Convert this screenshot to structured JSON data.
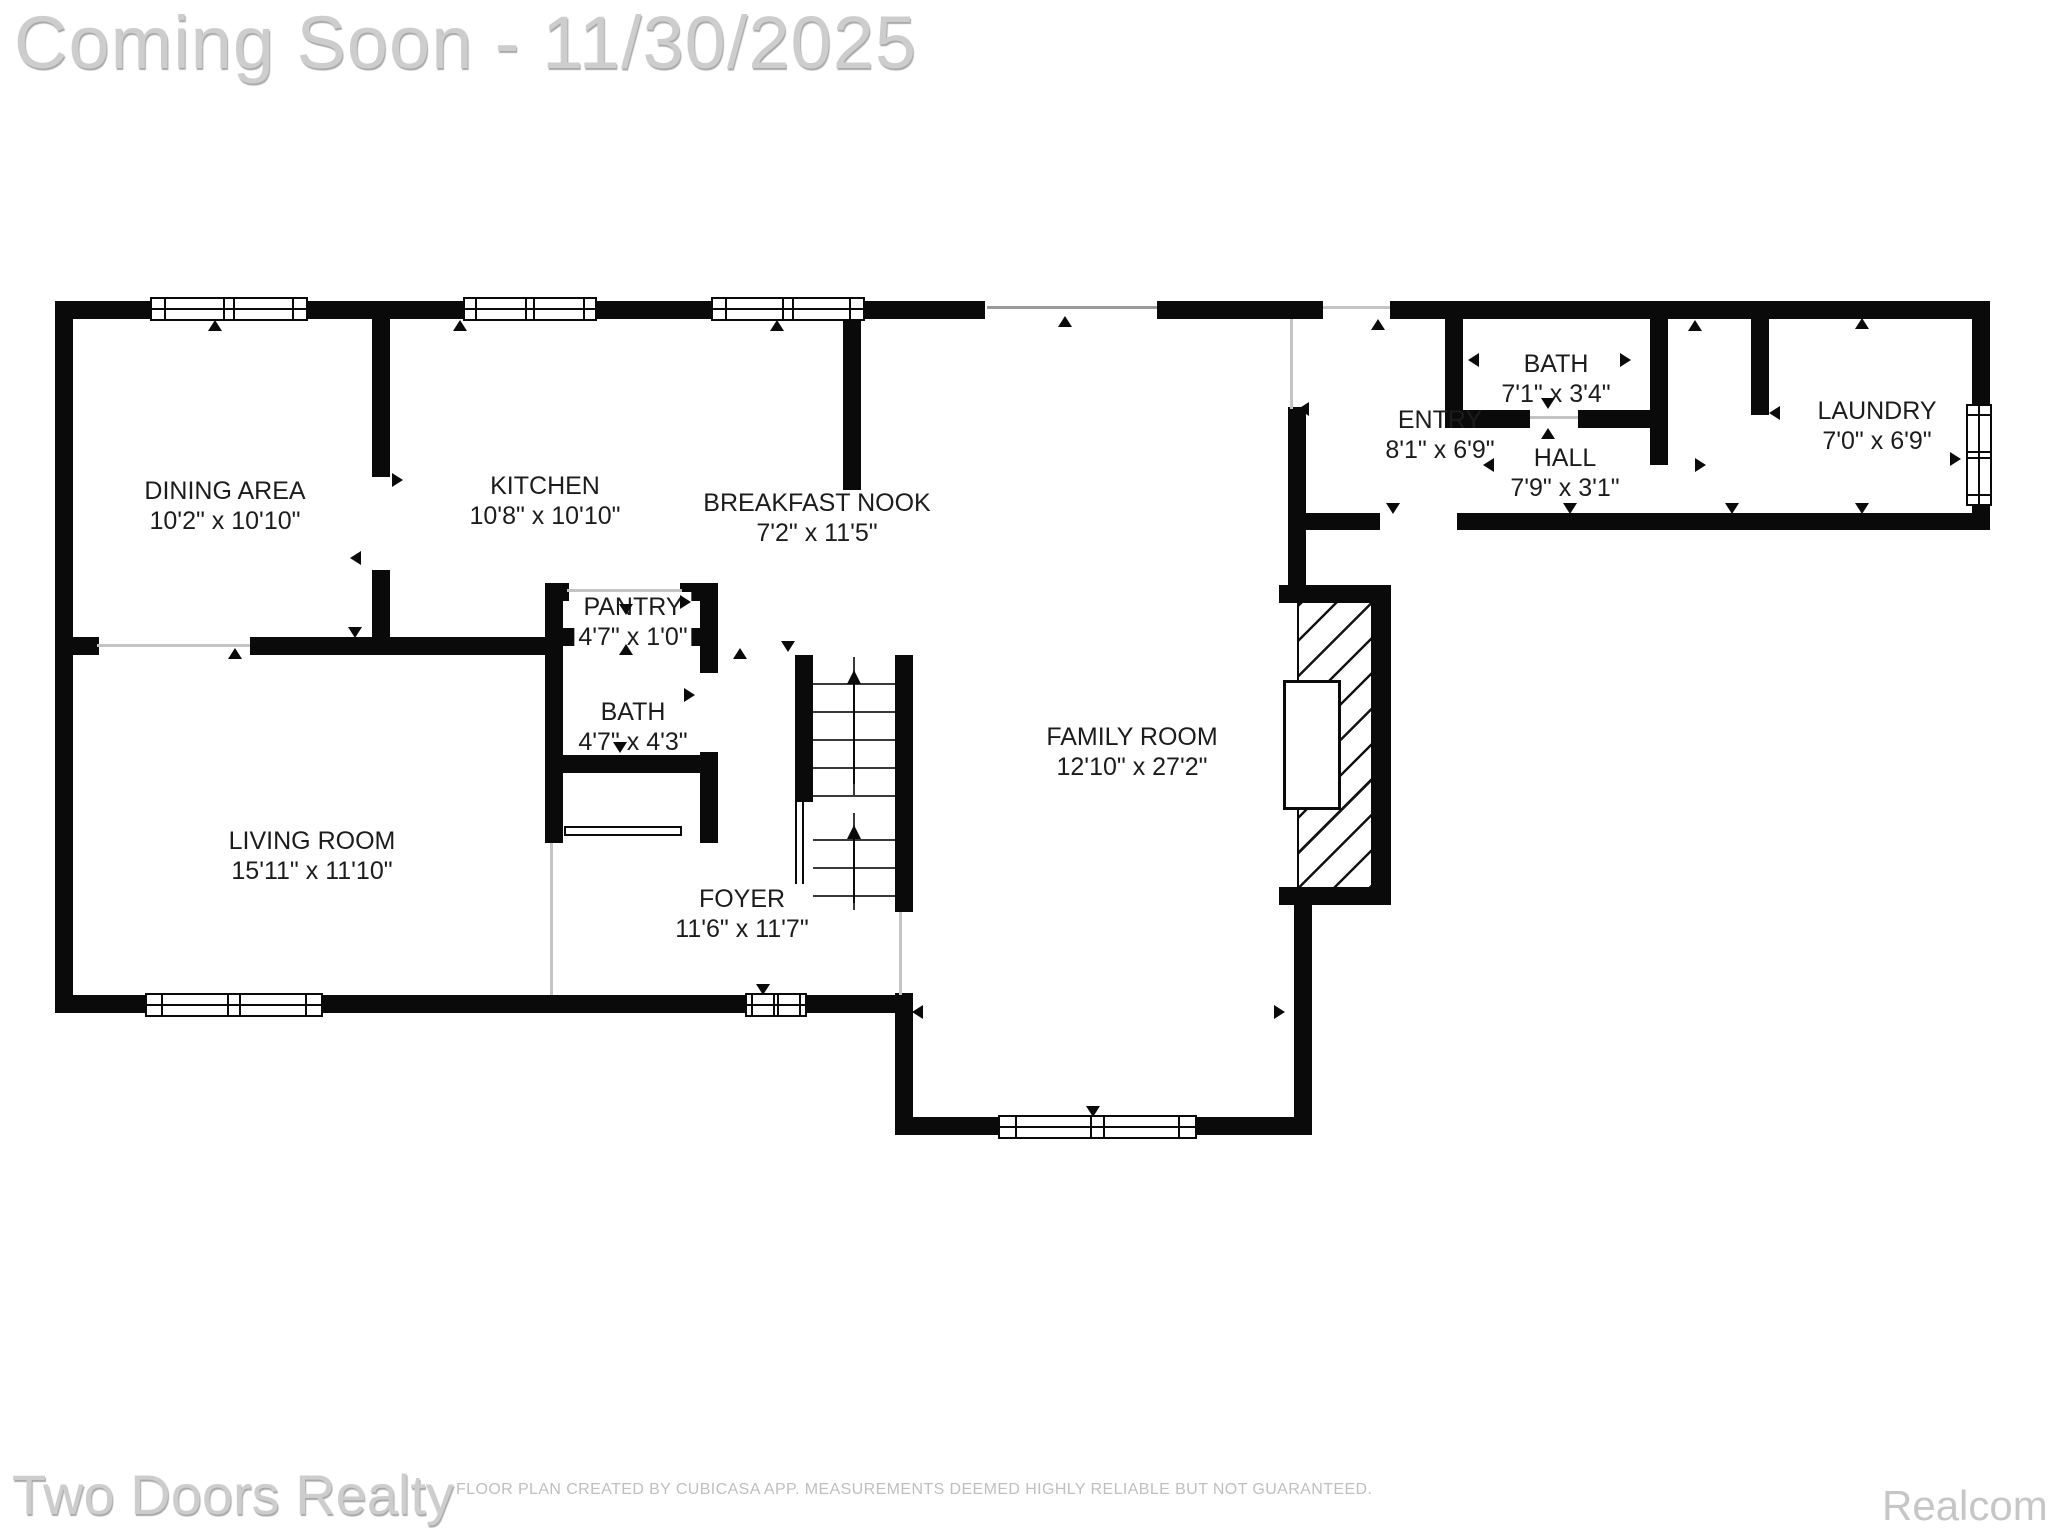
{
  "header": {
    "title": "Coming Soon - 11/30/2025"
  },
  "footer": {
    "brand": "Two Doors Realty",
    "disclaimer": "FLOOR PLAN CREATED BY CUBICASA APP. MEASUREMENTS DEEMED HIGHLY RELIABLE BUT NOT GUARANTEED.",
    "provider": "Realcomp"
  },
  "rooms": [
    {
      "name": "DINING AREA",
      "dims": "10'2\" x 10'10\""
    },
    {
      "name": "KITCHEN",
      "dims": "10'8\" x 10'10\""
    },
    {
      "name": "BREAKFAST NOOK",
      "dims": "7'2\" x 11'5\""
    },
    {
      "name": "PANTRY",
      "dims": "4'7\" x 1'0\""
    },
    {
      "name": "BATH",
      "dims": "4'7\" x 4'3\""
    },
    {
      "name": "LIVING ROOM",
      "dims": "15'11\" x 11'10\""
    },
    {
      "name": "FOYER",
      "dims": "11'6\" x 11'7\""
    },
    {
      "name": "FAMILY ROOM",
      "dims": "12'10\" x 27'2\""
    },
    {
      "name": "ENTRY",
      "dims": "8'1\" x 6'9\""
    },
    {
      "name": "BATH",
      "dims": "7'1\" x 3'4\""
    },
    {
      "name": "HALL",
      "dims": "7'9\" x 3'1\""
    },
    {
      "name": "LAUNDRY",
      "dims": "7'0\" x 6'9\""
    }
  ],
  "colors": {
    "wall": "#0a0a0a",
    "label": "#1c1c1c",
    "watermark": "#cdcdcd"
  }
}
